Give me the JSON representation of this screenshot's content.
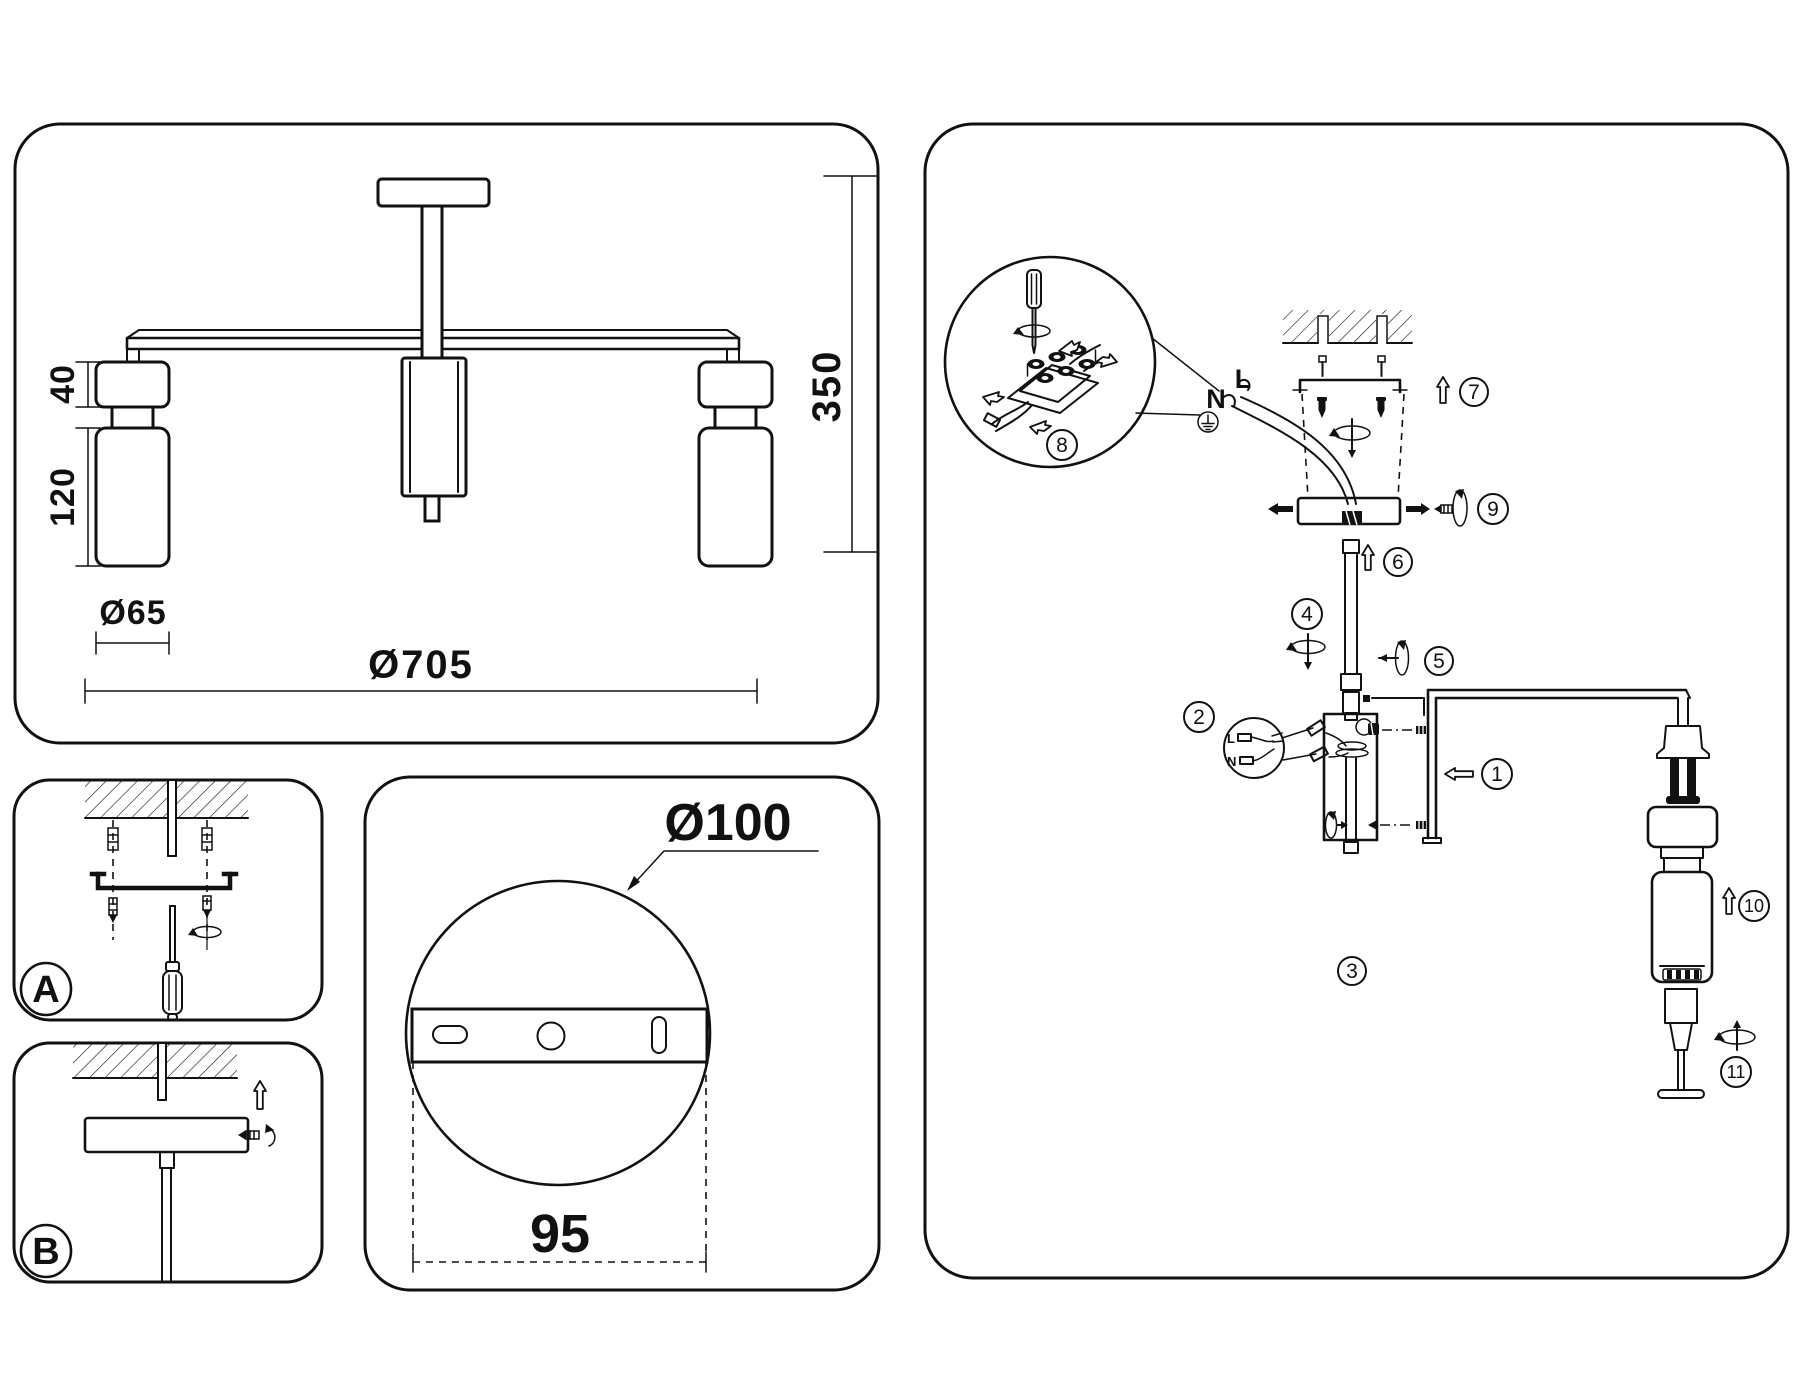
{
  "colors": {
    "line": "#111111",
    "background": "#ffffff"
  },
  "front_view": {
    "arm_height": "40",
    "shade_height": "120",
    "shade_diameter": "Ø65",
    "overall_diameter": "Ø705",
    "overall_height": "350"
  },
  "detail_a": {
    "label": "A"
  },
  "detail_b": {
    "label": "B"
  },
  "plate_view": {
    "plate_diameter": "Ø100",
    "mount_spacing": "95"
  },
  "assembly": {
    "wire_neutral": "N",
    "wire_live": "L",
    "balloon_live": "L",
    "balloon_neutral": "N",
    "steps": [
      "1",
      "2",
      "3",
      "4",
      "5",
      "6",
      "7",
      "8",
      "9",
      "10",
      "11"
    ]
  }
}
